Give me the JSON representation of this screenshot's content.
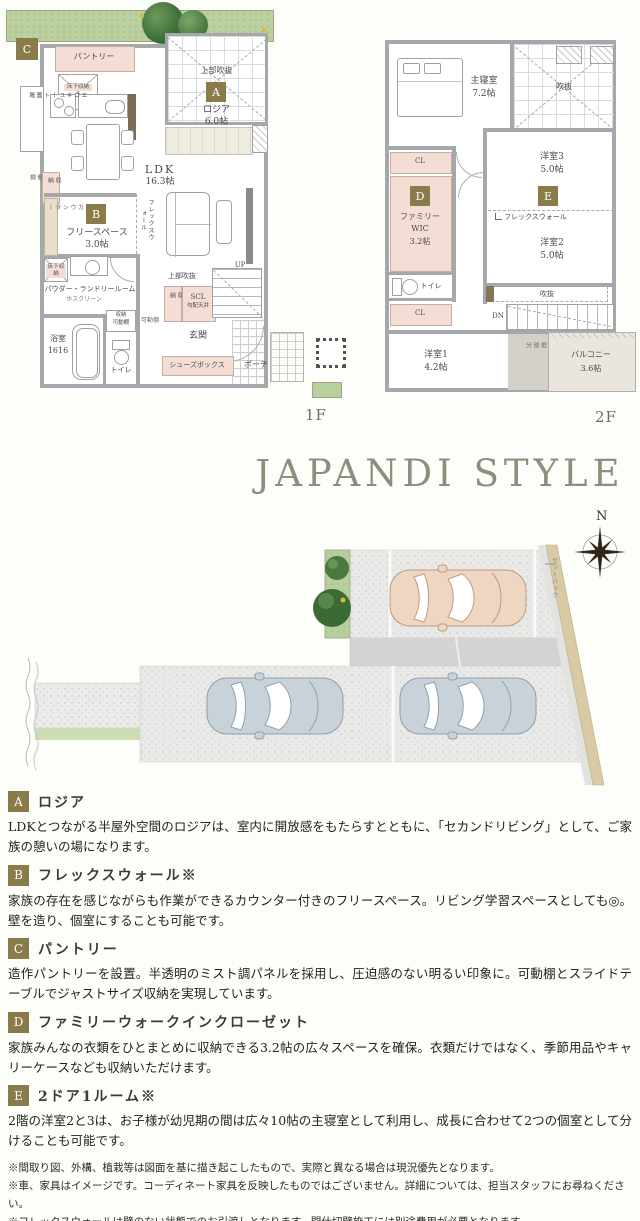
{
  "title": "JAPANDI STYLE",
  "compass": {
    "n": "N"
  },
  "site": {
    "setback": "セットバック"
  },
  "colors": {
    "badge": "#8a7b4b",
    "title": "#8e8e7c",
    "room_pink": "#f3ddd5",
    "lawn": "#bccf9e"
  },
  "plan1f": {
    "floor": "1F",
    "badge_a": "A",
    "badge_b": "B",
    "badge_c": "C",
    "pantry": "パントリー",
    "underfloor": "床下収納",
    "ecocute": "エコキュート置場",
    "storage": "収納",
    "movable": "可動棚",
    "counter": "カウンター",
    "freespace": "フリースペース",
    "freespace_size": "3.0帖",
    "flexwall": "フレックスウォール",
    "ldk": "LDK",
    "ldk_size": "16.3帖",
    "upper_void": "上部吹抜",
    "loggia": "ロジア",
    "loggia_size": "6.0帖",
    "powder_laundry": "パウダー・ランドリールーム",
    "hosclean": "ホスクリーン",
    "bath": "浴室",
    "bath_size": "1616",
    "toilet": "トイレ",
    "scl": "SCL",
    "scl_note": "勾配天井",
    "up": "UP",
    "entrance": "玄関",
    "shoes_box": "シューズボックス",
    "porch": "ポーチ"
  },
  "plan2f": {
    "floor": "2F",
    "badge_d": "D",
    "badge_e": "E",
    "master": "主寝室",
    "master_size": "7.2帖",
    "void": "吹抜",
    "cl": "CL",
    "fwic_line1": "ファミリー",
    "fwic_line2": "WIC",
    "fwic_size": "3.2帖",
    "room3": "洋室3",
    "room3_size": "5.0帖",
    "flexwall": "フレックスウォール",
    "room2": "洋室2",
    "room2_size": "5.0帖",
    "toilet": "トイレ",
    "dn": "DN",
    "room1": "洋室1",
    "room1_size": "4.2帖",
    "roof": "屋根部分",
    "balcony": "バルコニー",
    "balcony_size": "3.6帖"
  },
  "features": [
    {
      "badge": "A",
      "title": "ロジア",
      "body": "LDKとつながる半屋外空間のロジアは、室内に開放感をもたらすとともに、「セカンドリビング」として、ご家族の憩いの場になります。"
    },
    {
      "badge": "B",
      "title": "フレックスウォール※",
      "body": "家族の存在を感じながらも作業ができるカウンター付きのフリースペース。リビング学習スペースとしても◎。壁を造り、個室にすることも可能です。"
    },
    {
      "badge": "C",
      "title": "パントリー",
      "body": "造作パントリーを設置。半透明のミスト調パネルを採用し、圧迫感のない明るい印象に。可動棚とスライドテーブルでジャストサイズ収納を実現しています。"
    },
    {
      "badge": "D",
      "title": "ファミリーウォークインクローゼット",
      "body": "家族みんなの衣類をひとまとめに収納できる3.2帖の広々スペースを確保。衣類だけではなく、季節用品やキャリーケースなども収納いただけます。"
    },
    {
      "badge": "E",
      "title": "2ドア1ルーム※",
      "body": "2階の洋室2と3は、お子様が幼児期の間は広々10帖の主寝室として利用し、成長に合わせて2つの個室として分けることも可能です。"
    }
  ],
  "notes": [
    "※間取り図、外構、植栽等は図面を基に描き起こしたもので、実際と異なる場合は現況優先となります。",
    "※車、家具はイメージです。コーディネート家具を反映したものではございません。詳細については、担当スタッフにお尋ねください。",
    "※フレックスウォールは壁のない状態でのお引渡しとなります。間仕切壁施工には別途費用が必要となります。",
    "※普通自動車2台+軽自動車1台※車種・サイズによる"
  ]
}
